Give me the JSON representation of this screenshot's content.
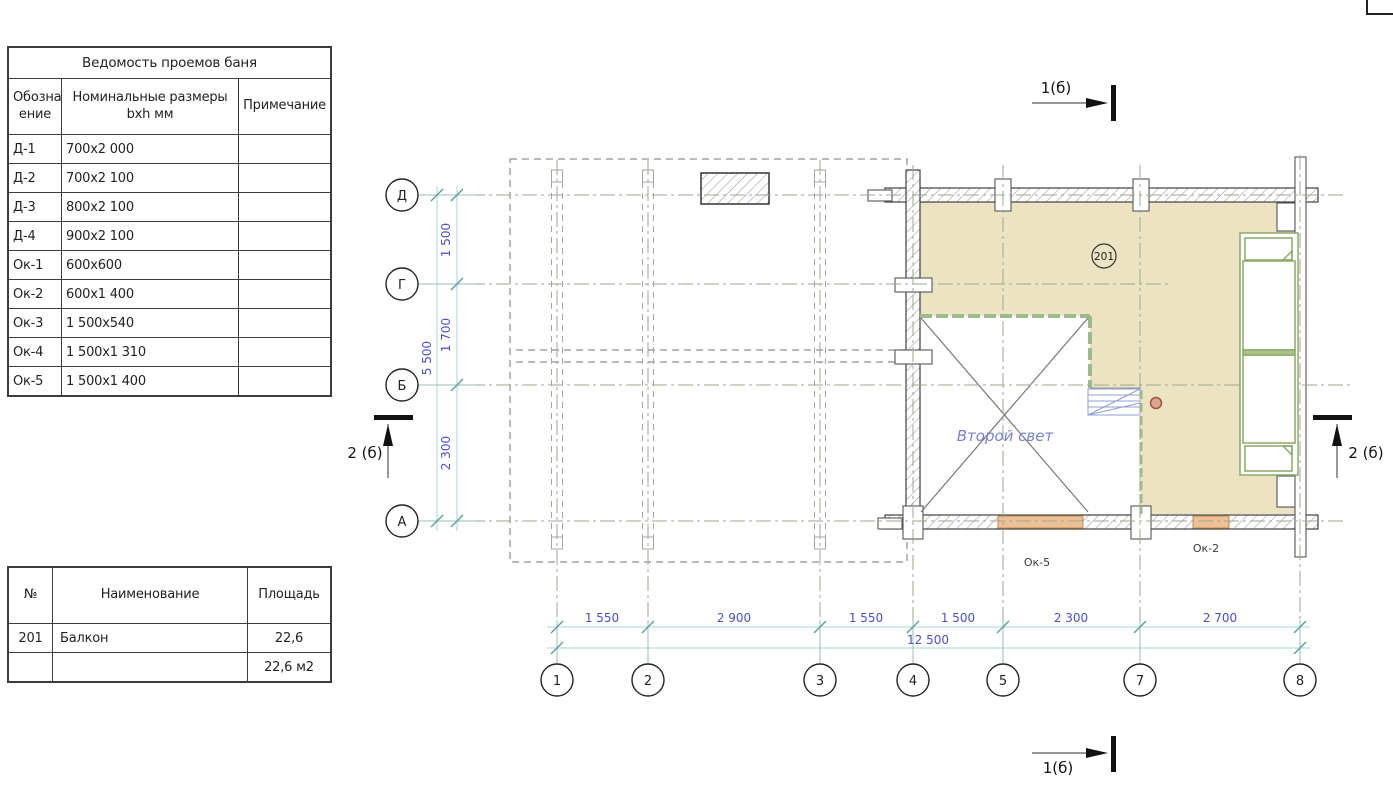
{
  "tables": {
    "openings": {
      "title": "Ведомость проемов баня",
      "headers": [
        "Обознач ение",
        "Номинальные размеры  bxh  мм",
        "Примечание"
      ],
      "rows": [
        {
          "mark": "Д-1",
          "size": "700x2 000",
          "note": ""
        },
        {
          "mark": "Д-2",
          "size": "700x2 100",
          "note": ""
        },
        {
          "mark": "Д-3",
          "size": "800x2 100",
          "note": ""
        },
        {
          "mark": "Д-4",
          "size": "900x2 100",
          "note": ""
        },
        {
          "mark": "Ок-1",
          "size": "600x600",
          "note": ""
        },
        {
          "mark": "Ок-2",
          "size": "600x1 400",
          "note": ""
        },
        {
          "mark": "Ок-3",
          "size": "1 500x540",
          "note": ""
        },
        {
          "mark": "Ок-4",
          "size": "1 500x1 310",
          "note": ""
        },
        {
          "mark": "Ок-5",
          "size": "1 500x1 400",
          "note": ""
        }
      ]
    },
    "areas": {
      "headers": [
        "№",
        "Наименование",
        "Площадь"
      ],
      "row": {
        "num": "201",
        "name": "Балкон",
        "area": "22,6"
      },
      "total": "22,6 м2"
    }
  },
  "plan": {
    "axes": {
      "rows": [
        "Д",
        "Г",
        "Б",
        "А"
      ],
      "cols": [
        "1",
        "2",
        "3",
        "4",
        "5",
        "7",
        "8"
      ]
    },
    "dims": {
      "v_segments": [
        "1 500",
        "1 700",
        "2 300"
      ],
      "v_total": "5 500",
      "h_segments": [
        "1 550",
        "2 900",
        "1 550",
        "1 500",
        "2 300",
        "2 700"
      ],
      "h_total": "12 500"
    },
    "labels": {
      "room_tag": "201",
      "second_light": "Второй свет",
      "window_ok5": "Ок-5",
      "window_ok2": "Ок-2",
      "section_1": "1(б)",
      "section_2": "2 (б)"
    },
    "colors": {
      "balcony_fill": "#ece3c3",
      "window_fill": "#eec096",
      "window_edge": "#c08a55",
      "furniture_green": "#8aaa68",
      "void_edge": "#9cba8c",
      "dim_text": "#4a4fc8",
      "note_text": "#7b7fd4",
      "stair_blue": "#8fa0d0"
    }
  }
}
